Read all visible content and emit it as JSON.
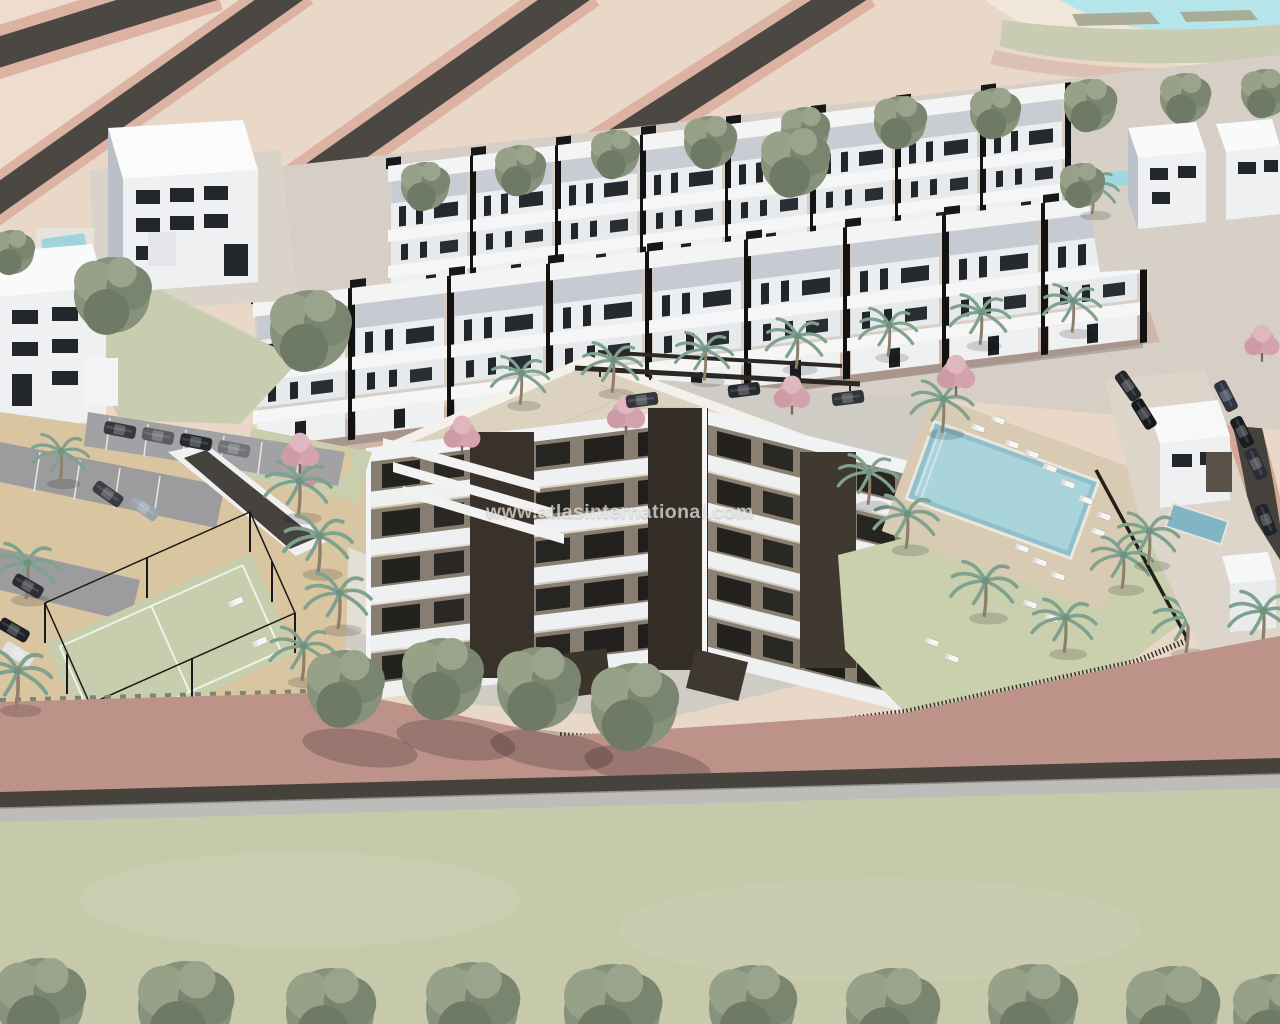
{
  "watermark": {
    "text": "www.atlasinternational.com"
  },
  "palette": {
    "terrain_beige": "#e9d7c7",
    "road_dark": "#47433f",
    "sidewalk_pink": "#dcb3a3",
    "promenade_pink": "#bd9289",
    "green_patch": "#c9ccb2",
    "field_green": "#c7c9ab",
    "water_cyan": "#b5e5eb",
    "pool_blue": "#8fc0cc",
    "lawn_green": "#cacfae",
    "court_green": "#c6cead",
    "sand": "#d9c6a0",
    "pavement": "#d7cfc6",
    "roof_cream": "#dcd2bf",
    "building_white": "#f0f1f3",
    "facade_taupe": "#877d70",
    "window_dark": "#1f2226",
    "wall_gray": "#bdbcb8",
    "tree_green": "#87927d",
    "palm_green": "#7fa18e",
    "blossom_pink": "#d8a9b2"
  }
}
